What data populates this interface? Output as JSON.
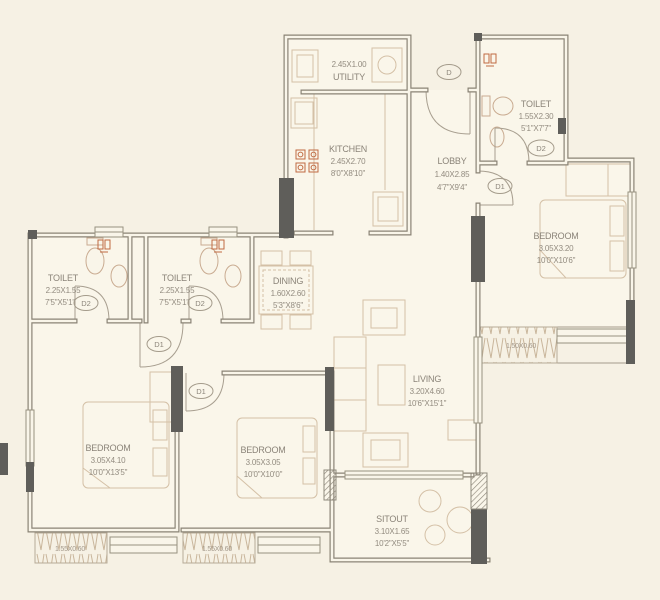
{
  "plan": {
    "type": "residential-floor-plan",
    "colors": {
      "background": "#f6f1e4",
      "floor": "#faf6ea",
      "wall": "#8a8375",
      "wall_dark": "#5f5e5a",
      "fixture": "#c9ab91",
      "furniture": "#d4c0a6",
      "accent_orange": "#c06a42",
      "text": "#8b8479"
    }
  },
  "rooms": [
    {
      "id": "utility",
      "name": "UTILITY",
      "size_m": "2.45X1.00",
      "size_ft": ""
    },
    {
      "id": "kitchen",
      "name": "KITCHEN",
      "size_m": "2.45X2.70",
      "size_ft": "8'0\"X8'10\""
    },
    {
      "id": "lobby",
      "name": "LOBBY",
      "size_m": "1.40X2.85",
      "size_ft": "4'7\"X9'4\""
    },
    {
      "id": "toilet-top",
      "name": "TOILET",
      "size_m": "1.55X2.30",
      "size_ft": "5'1\"X7'7\""
    },
    {
      "id": "bedroom-right",
      "name": "BEDROOM",
      "size_m": "3.05X3.20",
      "size_ft": "10'0\"X10'6\""
    },
    {
      "id": "toilet-left-1",
      "name": "TOILET",
      "size_m": "2.25X1.55",
      "size_ft": "7'5\"X5'1\""
    },
    {
      "id": "toilet-left-2",
      "name": "TOILET",
      "size_m": "2.25X1.55",
      "size_ft": "7'5\"X5'1\""
    },
    {
      "id": "dining",
      "name": "DINING",
      "size_m": "1.60X2.60",
      "size_ft": "5'3\"X8'6\""
    },
    {
      "id": "living",
      "name": "LIVING",
      "size_m": "3.20X4.60",
      "size_ft": "10'6\"X15'1\""
    },
    {
      "id": "bedroom-left",
      "name": "BEDROOM",
      "size_m": "3.05X4.10",
      "size_ft": "10'0\"X13'5\""
    },
    {
      "id": "bedroom-middle",
      "name": "BEDROOM",
      "size_m": "3.05X3.05",
      "size_ft": "10'0\"X10'0\""
    },
    {
      "id": "sitout",
      "name": "SITOUT",
      "size_m": "3.10X1.65",
      "size_ft": "10'2\"X5'5\""
    }
  ],
  "doors": [
    {
      "id": "main-entrance",
      "label": "D"
    },
    {
      "id": "toilet-top-door",
      "label": "D2"
    },
    {
      "id": "bedroom-right-door",
      "label": "D1"
    },
    {
      "id": "toilet-left-1-door",
      "label": "D2"
    },
    {
      "id": "toilet-left-2-door",
      "label": "D2"
    },
    {
      "id": "bedroom-left-door",
      "label": "D1"
    },
    {
      "id": "bedroom-middle-door",
      "label": "D1"
    }
  ],
  "ledges": [
    {
      "id": "balcony-right",
      "size": "1.50X0.60"
    },
    {
      "id": "ledge-bottom-left",
      "size": "1.55X0.60"
    },
    {
      "id": "ledge-bottom-middle",
      "size": "1.55X0.60"
    }
  ]
}
